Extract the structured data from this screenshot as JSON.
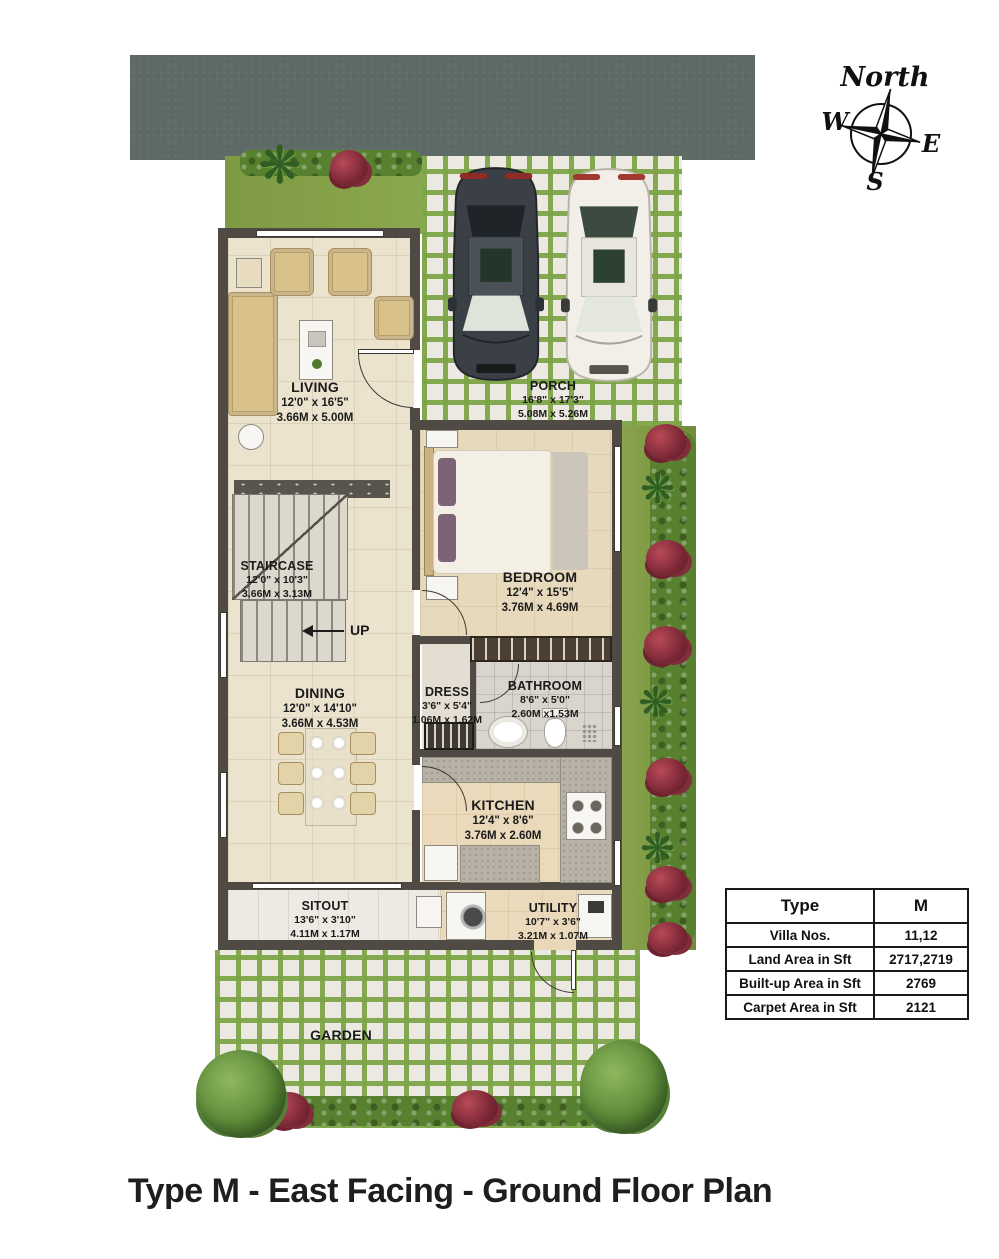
{
  "title": "Type M - East Facing - Ground Floor Plan",
  "compass": {
    "north": "North",
    "south": "S",
    "east": "E",
    "west": "W"
  },
  "rooms": {
    "living": {
      "name": "LIVING",
      "dim_ft": "12'0\" x 16'5\"",
      "dim_m": "3.66M x 5.00M"
    },
    "porch": {
      "name": "PORCH",
      "dim_ft": "16'8\" x 17'3\"",
      "dim_m": "5.08M x 5.26M"
    },
    "bedroom": {
      "name": "BEDROOM",
      "dim_ft": "12'4\" x 15'5\"",
      "dim_m": "3.76M x 4.69M"
    },
    "staircase": {
      "name": "STAIRCASE",
      "dim_ft": "12'0\" x 10'3\"",
      "dim_m": "3.66M x 3.13M"
    },
    "dining": {
      "name": "DINING",
      "dim_ft": "12'0\" x 14'10\"",
      "dim_m": "3.66M x 4.53M"
    },
    "dress": {
      "name": "DRESS",
      "dim_ft": "3'6\" x 5'4\"",
      "dim_m": "1.06M x 1.62M"
    },
    "bathroom": {
      "name": "BATHROOM",
      "dim_ft": "8'6\" x 5'0\"",
      "dim_m": "2.60M x1.53M"
    },
    "kitchen": {
      "name": "KITCHEN",
      "dim_ft": "12'4\" x 8'6\"",
      "dim_m": "3.76M x 2.60M"
    },
    "sitout": {
      "name": "SITOUT",
      "dim_ft": "13'6\" x 3'10\"",
      "dim_m": "4.11M x 1.17M"
    },
    "utility": {
      "name": "UTILITY",
      "dim_ft": "10'7\" x 3'6\"",
      "dim_m": "3.21M x 1.07M"
    },
    "garden": {
      "name": "GARDEN"
    },
    "up_label": "UP"
  },
  "spec_table": {
    "header": {
      "label": "Type",
      "value": "M"
    },
    "rows": [
      {
        "label": "Villa Nos.",
        "value": "11,12"
      },
      {
        "label": "Land Area in Sft",
        "value": "2717,2719"
      },
      {
        "label": "Built-up Area in Sft",
        "value": "2769"
      },
      {
        "label": "Carpet Area in Sft",
        "value": "2121"
      }
    ]
  },
  "icons": {
    "compass-rose-icon": "4-point star compass rose",
    "car-dark-icon": "dark grey sedan, top view",
    "car-white-icon": "white sedan, top view",
    "tree-icon": "round tree canopy, top view",
    "palm-icon": "palm plant starburst, top view",
    "flower-bush-icon": "red flowering shrub, top view",
    "hedge-icon": "trimmed hedge strip",
    "up-arrow-icon": "stair direction arrow pointing left"
  },
  "colors": {
    "road": "#5d6a66",
    "grass": "#7e9a43",
    "grout_green": "#7ea448",
    "wall": "#4f4a43",
    "floor_living": "#ece3cf",
    "floor_bedroom": "#e7d9bb",
    "sofa_tan": "#d9c28a",
    "counter_grey": "#b7b2a5",
    "car_dark": "#3a4046",
    "car_white": "#f1efe8",
    "flower_red": "#7c2736",
    "text": "#1b1b1b"
  }
}
